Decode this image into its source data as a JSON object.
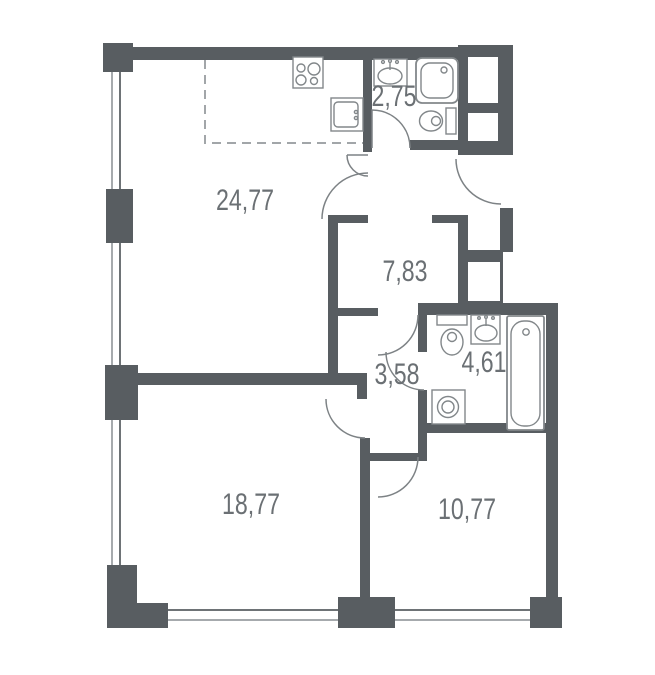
{
  "floor_plan": {
    "rooms": [
      {
        "id": "kitchen-living",
        "area_label": "24,77"
      },
      {
        "id": "bathroom-top",
        "area_label": "2,75"
      },
      {
        "id": "hallway",
        "area_label": "7,83"
      },
      {
        "id": "hallway-inner",
        "area_label": "3,58"
      },
      {
        "id": "bathroom-main",
        "area_label": "4,61"
      },
      {
        "id": "bedroom-large",
        "area_label": "18,77"
      },
      {
        "id": "bedroom-small",
        "area_label": "10,77"
      }
    ],
    "fixtures": [
      "stove-icon",
      "kitchen-sink-icon",
      "washbasin-icon",
      "shower-icon",
      "toilet-icon",
      "toilet-icon",
      "washbasin-icon",
      "bathtub-icon",
      "washing-machine-icon"
    ],
    "colors": {
      "wall": "#585d61",
      "fixture_outline": "#82878a",
      "label_text": "#6b7074",
      "window_line": "#a6aaad",
      "dashed_zone": "#a2a6a9",
      "background": "#ffffff"
    }
  }
}
